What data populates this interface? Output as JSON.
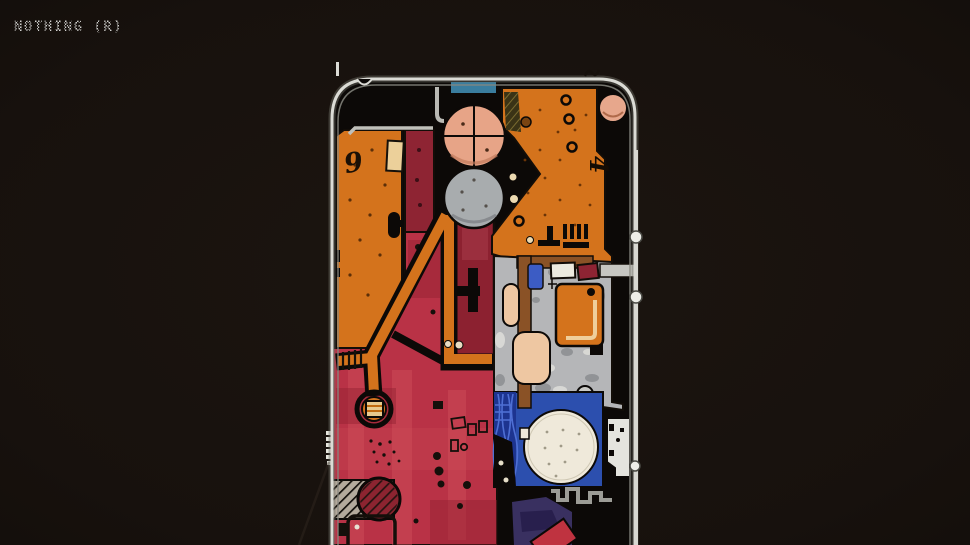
{
  "header": {
    "logo_text": "NOTHING (R)"
  },
  "image": {
    "description": "Hand-drawn marker concept sketch of a smartphone's internal components (transparent-back design) on a dark background",
    "handwritten_marks": [
      "9",
      "4"
    ],
    "palette": {
      "background": "#18120e",
      "logo": "#d2d2d0",
      "frame_silver": "#dbdbd5",
      "pcb_orange": "#d4731c",
      "battery_red": "#b93246",
      "maroon": "#8e2433",
      "camera_peach": "#e7a487",
      "lens_gray": "#a8acae",
      "module_gray": "#b5b6b8",
      "speaker_blue": "#2c4fae",
      "speaker_cream": "#efe9da",
      "accent_blue": "#3c5cc4",
      "teal_bar": "#3a7d9e",
      "purple_patch": "#393060",
      "brown": "#8a5226",
      "tan": "#ecd09a"
    }
  }
}
